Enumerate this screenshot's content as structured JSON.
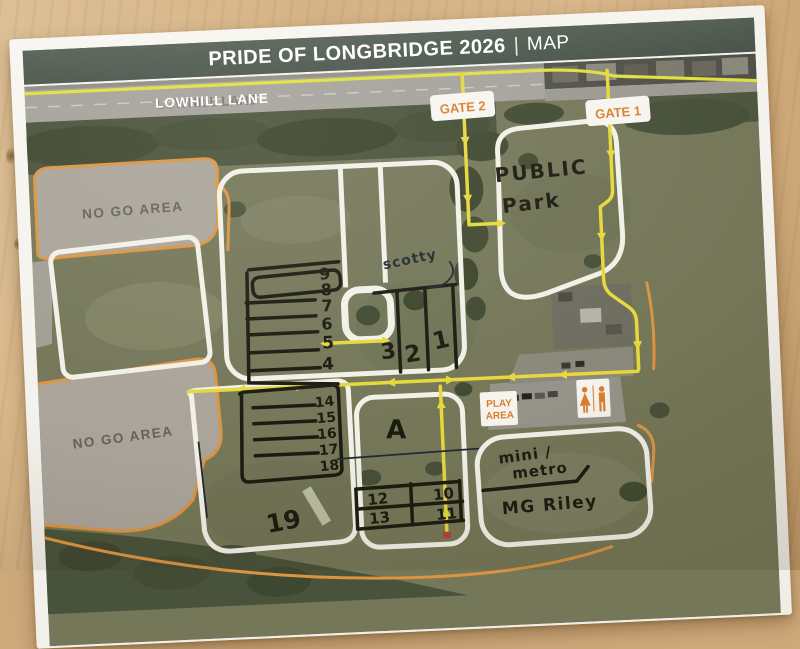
{
  "header": {
    "title": "PRIDE OF LONGBRIDGE 2026",
    "separator": "|",
    "suffix": "MAP"
  },
  "road": {
    "label": "LOWHILL LANE"
  },
  "gates": {
    "gate2": "GATE 2",
    "gate1": "GATE 1"
  },
  "zones": {
    "no_go_top": "NO GO AREA",
    "no_go_bottom": "NO GO AREA",
    "public_park": [
      "PUBLIC",
      "Park"
    ],
    "play_area": [
      "PLAY",
      "AREA"
    ]
  },
  "handwriting": {
    "scotty": "scotty",
    "rows_upper": [
      "9",
      "8",
      "7",
      "6",
      "5",
      "4"
    ],
    "rows_lower": [
      "14",
      "15",
      "16",
      "17",
      "18"
    ],
    "lanes": [
      "3",
      "2",
      "1"
    ],
    "area_a": "A",
    "area_19": "19",
    "grid": {
      "r1c1": "12",
      "r1c2": "10",
      "r2c1": "13",
      "r2c2": "11"
    },
    "clubs": [
      "mini /",
      "metro",
      "MG Riley"
    ]
  },
  "icons": {
    "toilets": "male-female-restroom"
  },
  "colors": {
    "header_bg": "#4b564c",
    "header_text": "#ffffff",
    "route_yellow": "#e6d83c",
    "route_orange": "#dd9440",
    "boundary_white": "#f2f1e8",
    "marker_black": "#1b1b10",
    "pen_blue": "#222a35",
    "gate_text": "#d87f2f",
    "no_go_grey": "#aaa49a",
    "field_green": "#747758",
    "tree_green": "#3e472f",
    "road_grey": "#a4a29a",
    "paper": "#f6f4ef",
    "desk_wood": "#d2ae7e"
  }
}
